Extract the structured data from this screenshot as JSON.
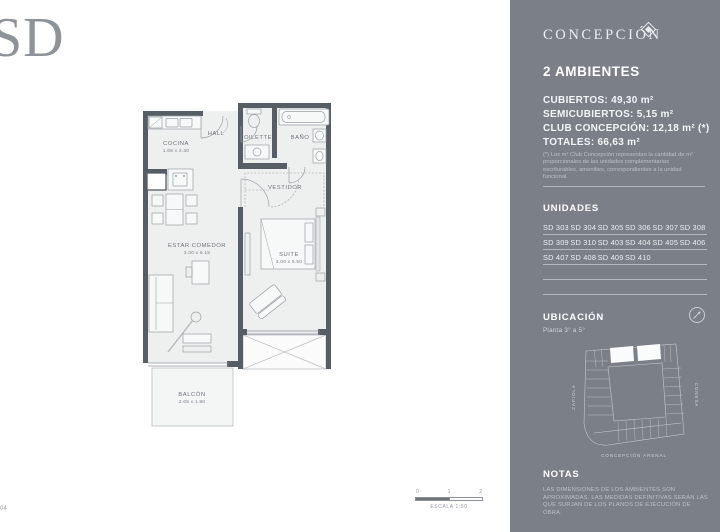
{
  "page": {
    "brand_logo": "SD",
    "sheet_code": "04"
  },
  "plan": {
    "rooms": {
      "cocina": {
        "name": "COCINA",
        "dims": "1.65 x 2.30"
      },
      "hall": {
        "name": "HALL"
      },
      "toilette": {
        "name": "TOILETTE"
      },
      "bano": {
        "name": "BAÑO"
      },
      "vestidor": {
        "name": "VESTIDOR"
      },
      "estar": {
        "name": "ESTAR COMEDOR",
        "dims": "3.00 x 6.15"
      },
      "suite": {
        "name": "SUITE",
        "dims": "3.00 x 5.50"
      },
      "balcon": {
        "name": "BALCÓN",
        "dims": "2.65 x 1.90"
      }
    },
    "scale": {
      "ticks": [
        "0",
        "1",
        "2"
      ],
      "label": "ESCALA 1:50"
    }
  },
  "panel": {
    "brand": "CONCEPCIÓN",
    "title": "2 AMBIENTES",
    "areas": [
      "CUBIERTOS: 49,30 m²",
      "SEMICUBIERTOS: 5,15 m²",
      "CLUB CONCEPCIÓN: 12,18 m² (*)",
      "TOTALES: 66,63 m²"
    ],
    "footnote": "(*) Los m² Club Concepción representan la cantidad de m² proporcionales de las unidades complementarias escriturables, amenities, correspondientes a la unidad funcional.",
    "unidades": {
      "heading": "UNIDADES",
      "units": [
        "SD 303",
        "SD 304",
        "SD 305",
        "SD 306",
        "SD 307",
        "SD 308",
        "SD 309",
        "SD 310",
        "SD 403",
        "SD 404",
        "SD 405",
        "SD 406",
        "SD 407",
        "SD 408",
        "SD 409",
        "SD 410"
      ]
    },
    "ubicacion": {
      "heading": "UBICACIÓN",
      "subtitle": "Planta 3° a 5°",
      "streets": {
        "left": "ZAPIOLA",
        "right": "CONESA",
        "bottom": "CONCEPCIÓN ARENAL"
      }
    },
    "notas": {
      "heading": "NOTAS",
      "text": "LAS DIMENSIONES DE LOS AMBIENTES SON APROXIMADAS. LAS MEDIDAS DEFINITIVAS SERÁN LAS QUE SURJAN DE LOS PLANOS DE EJECUCIÓN DE OBRA."
    },
    "colors": {
      "panel_bg": "#7a7f88",
      "wall": "#575d65",
      "floor": "#eef0ef"
    }
  }
}
